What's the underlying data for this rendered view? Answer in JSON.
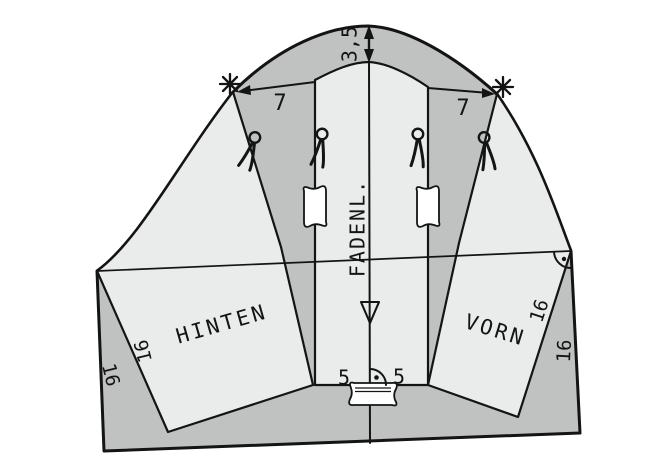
{
  "diagram": {
    "labels": {
      "cap_raise": "3,5",
      "spread_left": "7",
      "spread_right": "7",
      "grainline": "FADENL.",
      "back": "HINTEN",
      "front": "VORN",
      "hem_left": "5",
      "hem_right": "5",
      "len_outer_left": "16",
      "len_inner_left": "16",
      "len_inner_right": "16",
      "len_outer_right": "16"
    },
    "icons": {
      "scissors": "✂",
      "match_star": "✳",
      "notch_triangle": "▽",
      "right_angle_with_dot": "⊾·"
    },
    "colors": {
      "background": "#ffffff",
      "base_shape": "#c0c2c2",
      "pattern_piece": "#eaebeb",
      "line": "#141414"
    }
  }
}
